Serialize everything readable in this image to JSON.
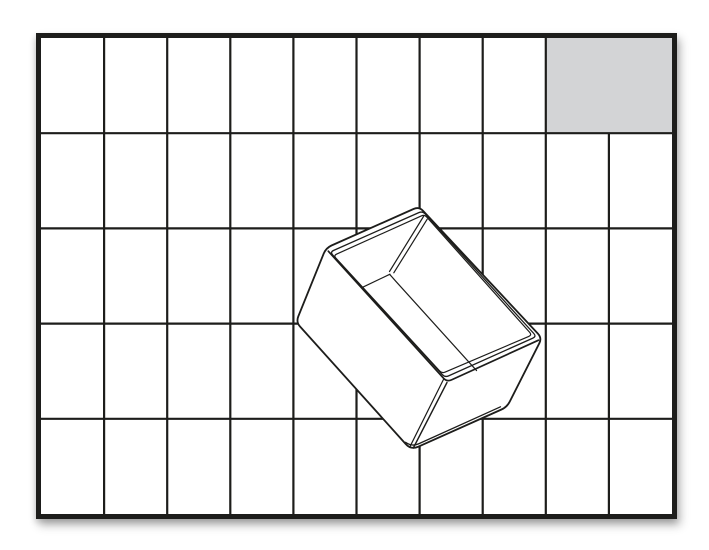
{
  "illustration": {
    "title": "insert-unit-size-diagram",
    "description": "Black-and-white line-art size diagram: a base-unit grid with one highlighted 2x1 footprint cell in the top-right corner and a 3D outline drawing of an open rectangular storage insert bin placed diagonally on the grid",
    "colors": {
      "line": "#1d1d1b",
      "background": "#ffffff",
      "highlight_fill": "#d3d4d6"
    },
    "grid": {
      "columns": 10,
      "rows": 5,
      "x0": 41,
      "y0": 38,
      "x1": 672,
      "y1": 514,
      "line_width": 2.2,
      "border_width": 5
    },
    "highlight_cell": {
      "row": 1,
      "column_start": 9,
      "column_span": 2,
      "row_span": 1
    }
  }
}
